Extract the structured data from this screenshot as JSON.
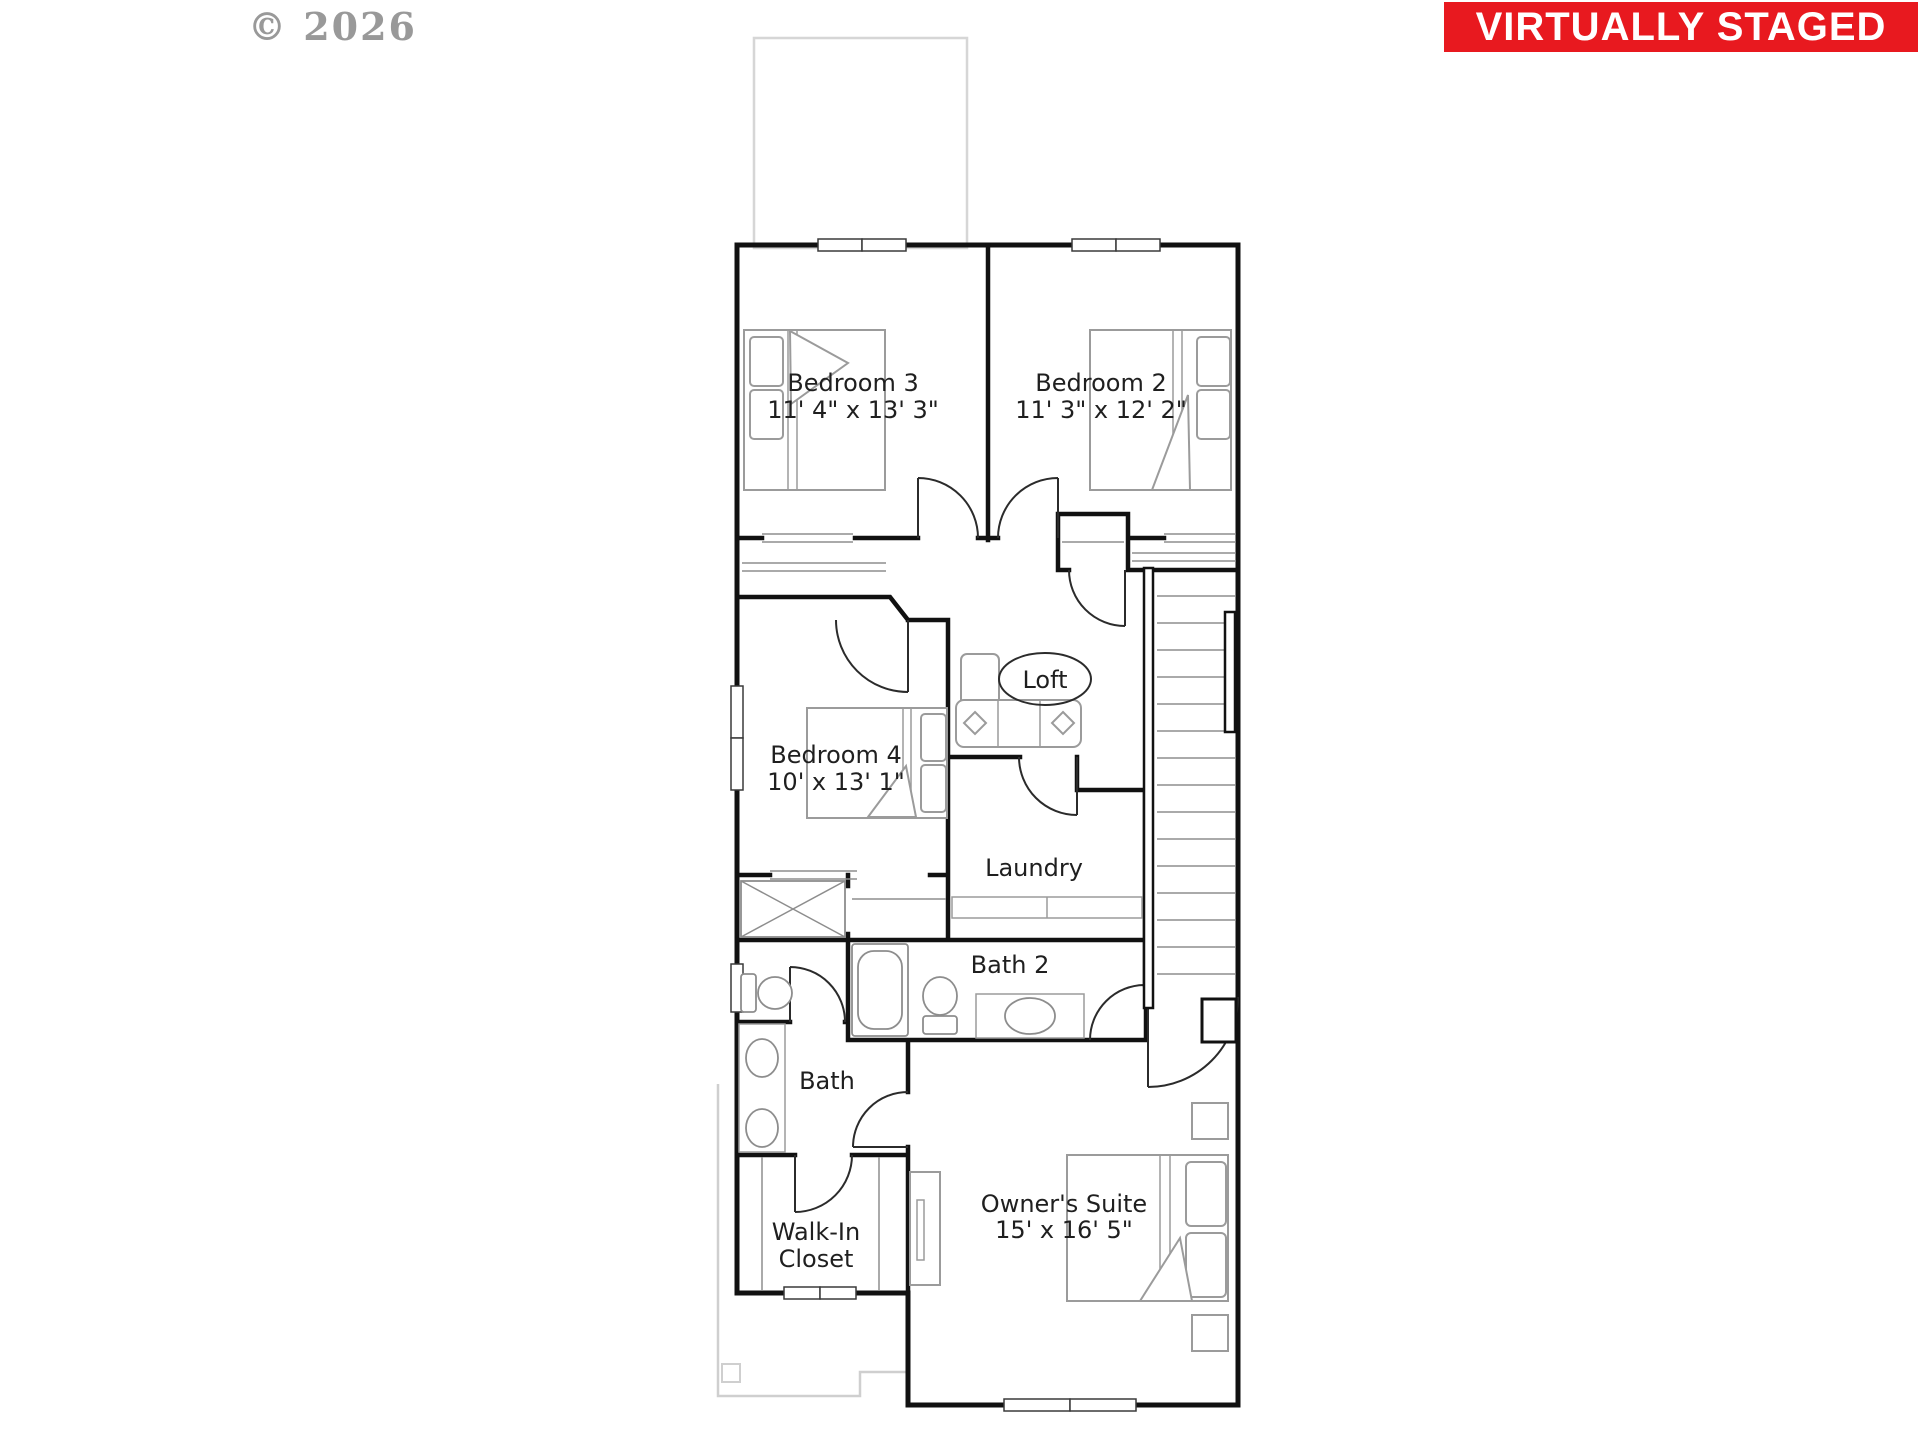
{
  "watermark": {
    "text": "© 2026"
  },
  "banner": {
    "text": "VIRTUALLY STAGED"
  },
  "colors": {
    "banner-bg": "#e8191f",
    "banner-fg": "#ffffff",
    "watermark-color": "#8f8f8f",
    "wall": "#111111",
    "furniture": "#9b9b9b",
    "roofline": "#d6d6d6",
    "label": "#1f1f1f"
  },
  "rooms": {
    "bedroom3": {
      "label": "Bedroom 3",
      "dims": "11' 4\" x 13' 3\""
    },
    "bedroom2": {
      "label": "Bedroom 2",
      "dims": "11' 3\" x 12' 2\""
    },
    "bedroom4": {
      "label": "Bedroom 4",
      "dims": "10' x 13' 1\""
    },
    "loft": {
      "label": "Loft"
    },
    "laundry": {
      "label": "Laundry"
    },
    "bath2": {
      "label": "Bath 2"
    },
    "bath": {
      "label": "Bath"
    },
    "walk_in_closet": {
      "label_line1": "Walk-In",
      "label_line2": "Closet"
    },
    "owners_suite": {
      "label": "Owner's Suite",
      "dims": "15' x 16' 5\""
    }
  }
}
